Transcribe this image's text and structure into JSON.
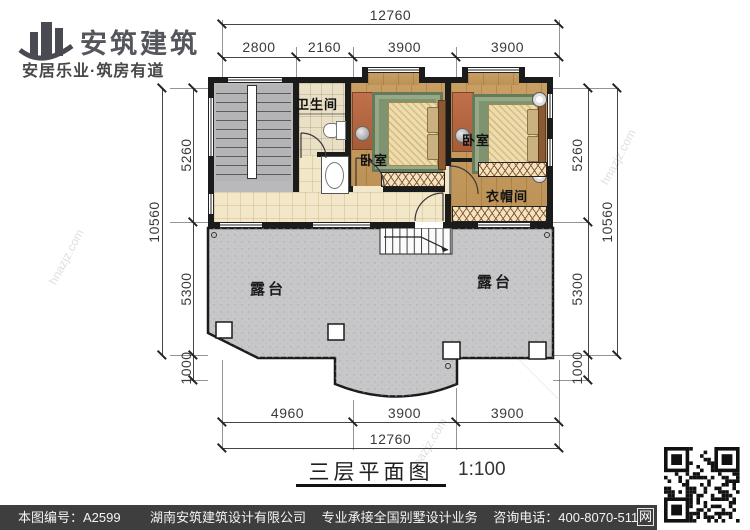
{
  "header": {
    "brand": "安筑建筑",
    "tagline": "安居乐业·筑房有道"
  },
  "plan": {
    "caption": {
      "title": "三层平面图",
      "scale": "1:100"
    },
    "rooms": {
      "bathroom": "卫生间",
      "bedroom": "卧室",
      "cloakroom": "衣帽间",
      "terrace": "露台"
    },
    "dims": {
      "top_total": "12760",
      "top_segments": [
        "2800",
        "2160",
        "3900",
        "3900"
      ],
      "bottom_segments": [
        "4960",
        "3900",
        "3900"
      ],
      "bottom_total": "12760",
      "left_segments": [
        "5260",
        "5300",
        "1000"
      ],
      "left_total": "10560",
      "right_segments": [
        "5260",
        "5300",
        "1000"
      ],
      "right_total": "10560"
    }
  },
  "watermark": {
    "site": "hnazjz.com",
    "brand": "安筑建筑"
  },
  "footer": {
    "drawing_no": "本图编号：A2599",
    "company": "湖南安筑建筑设计有限公司",
    "service": "专业承接全国别墅设计业务",
    "phone": "咨询电话：400-8070-511",
    "web_badge": "网"
  },
  "colors": {
    "wall": "#1b1b1b",
    "terrace_gray": "#c7c7c9",
    "wood": "#c89e62",
    "cream_tile": "#f2e7c9",
    "footer_bar": "#3e3e3e"
  }
}
